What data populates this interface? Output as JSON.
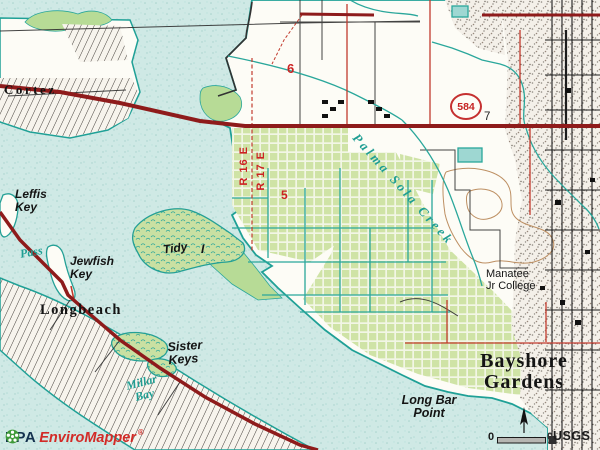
{
  "map": {
    "labels": {
      "cortez": "Cortez",
      "section_6": "6",
      "section_5": "5",
      "section_7": "7",
      "range_west": "R 16 E",
      "range_east": "R 17 E",
      "shield_584": "584",
      "palma_sola_creek": "Palma Sola Creek",
      "leffis_key": "Leffis\nKey",
      "pass": "Pass",
      "jewfish_key": "Jewfish\nKey",
      "tidy": "Tidy",
      "tidy_island_i": "I",
      "longbeach": "Longbeach",
      "sister_keys": "Sister\nKeys",
      "millar_bay": "Millar\nBay",
      "manatee_jr_college": "Manatee\nJr College",
      "bayshore_gardens": "Bayshore\nGardens",
      "long_bar_point": "Long Bar\nPoint"
    },
    "branding": {
      "epa": "EPA",
      "enviromapper": "EnviroMapper",
      "registered": "®"
    },
    "scale_bar": {
      "left_label": "0",
      "right_label": "0",
      "attribution": "USGS"
    },
    "colors": {
      "water": "#cfe9e5",
      "land": "#fdfcf6",
      "grove": "#cfe3a6",
      "marsh": "#c9e0a2",
      "canal_teal": "#2aa79b",
      "major_road": "#8e1b1b",
      "minor_road": "#c23b2e",
      "red_label": "#cc2222",
      "contour": "#bd8f62",
      "urban_base": "#f4f0e9",
      "brand_red": "#d22b27",
      "epa_green": "#3f9b3a"
    }
  }
}
